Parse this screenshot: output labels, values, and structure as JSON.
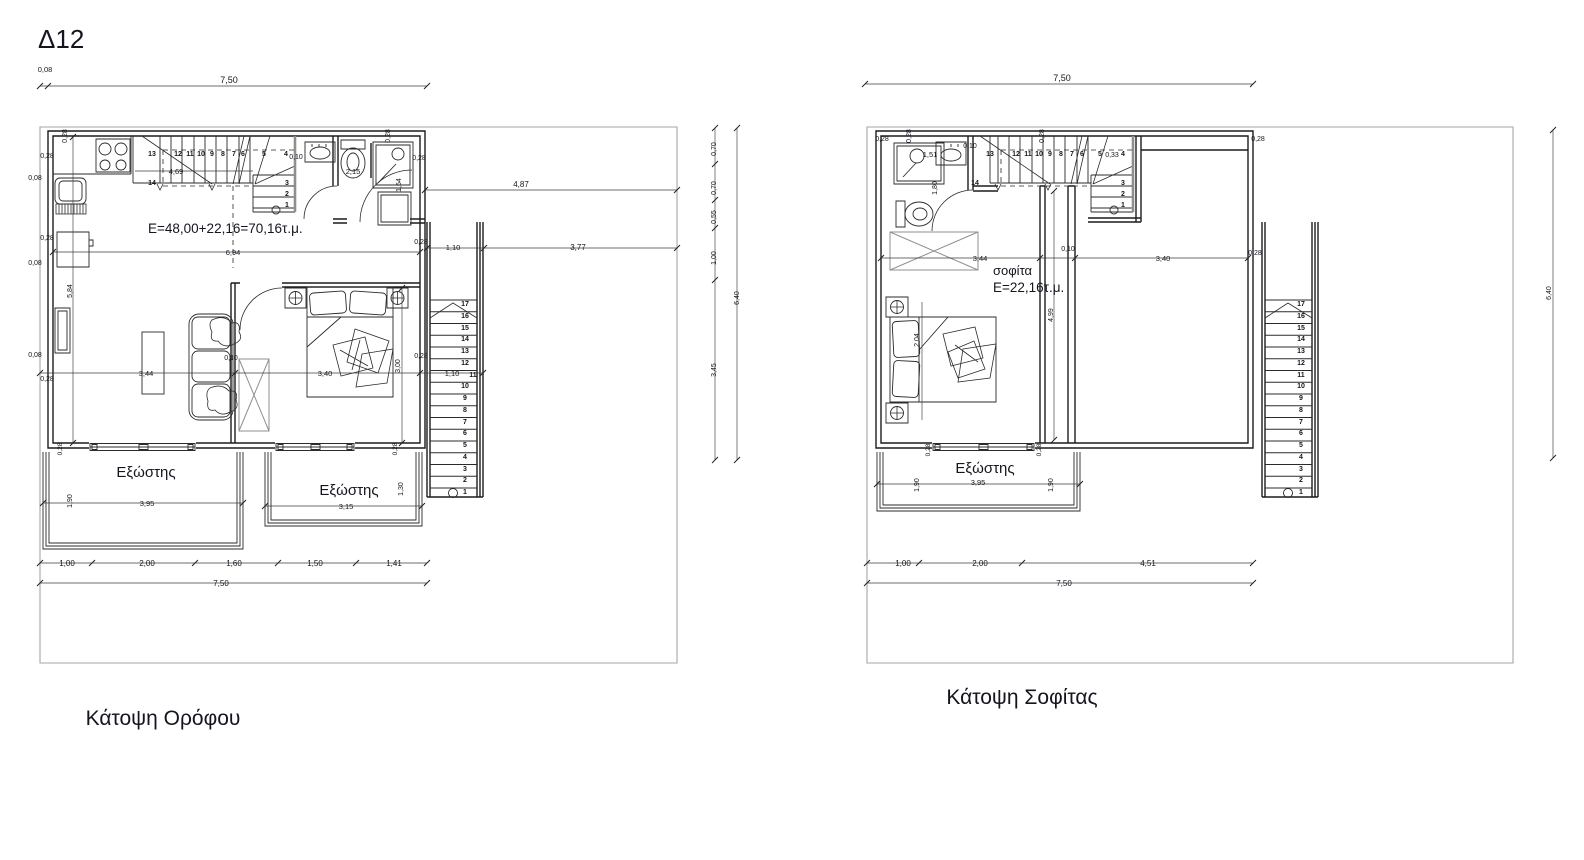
{
  "sheet": {
    "code": "Δ12"
  },
  "floor_plan": {
    "caption": "Κάτοψη Ορόφου",
    "area_label": "E=48,00+22,16=70,16τ.μ.",
    "balcony_labels": [
      "Εξώστης",
      "Εξώστης"
    ]
  },
  "attic_plan": {
    "caption": "Κάτοψη Σοφίτας",
    "room_label": "σοφίτα",
    "area_label": "E=22,16τ.μ.",
    "balcony_labels": [
      "Εξώστης"
    ]
  },
  "layers": [
    {
      "name": "sheet-labels",
      "labels": [
        {
          "t": "Δ12",
          "x": 38,
          "y": 48,
          "s": 26,
          "a": "start",
          "n": "sheet-code"
        }
      ]
    },
    {
      "name": "floor-plan-labels",
      "labels": [
        {
          "t": "Κάτοψη Ορόφου",
          "x": 163,
          "y": 725,
          "s": 21,
          "n": "floor-plan-caption"
        },
        {
          "t": "E=48,00+22,16=70,16τ.μ.",
          "x": 148,
          "y": 233,
          "s": 13.5,
          "a": "start",
          "n": "floor-area-label"
        },
        {
          "t": "Εξώστης",
          "x": 146,
          "y": 477,
          "s": 15,
          "n": "balcony-label"
        },
        {
          "t": "Εξώστης",
          "x": 349,
          "y": 495,
          "s": 15,
          "n": "balcony-label"
        },
        {
          "t": "0,08",
          "x": 45,
          "y": 72,
          "s": 7.5
        },
        {
          "t": "7,50",
          "x": 229,
          "y": 83,
          "s": 9
        },
        {
          "t": "0,28",
          "x": 67,
          "y": 136,
          "r": -90,
          "s": 7
        },
        {
          "t": "0,28",
          "x": 47,
          "y": 158,
          "s": 7
        },
        {
          "t": "0,08",
          "x": 35,
          "y": 180,
          "s": 7
        },
        {
          "t": "0,28",
          "x": 47,
          "y": 240,
          "s": 7
        },
        {
          "t": "0,08",
          "x": 35,
          "y": 265,
          "s": 7
        },
        {
          "t": "5,84",
          "x": 72,
          "y": 291,
          "r": -90,
          "s": 7
        },
        {
          "t": "0,08",
          "x": 35,
          "y": 357,
          "s": 7
        },
        {
          "t": "0,28",
          "x": 47,
          "y": 381,
          "s": 7
        },
        {
          "t": "4,69",
          "x": 176,
          "y": 174,
          "s": 7.5
        },
        {
          "t": "0,10",
          "x": 296,
          "y": 159,
          "s": 7
        },
        {
          "t": "2,15",
          "x": 353,
          "y": 174,
          "s": 7.5
        },
        {
          "t": "1,54",
          "x": 401,
          "y": 185,
          "r": -90,
          "s": 7
        },
        {
          "t": "0,28",
          "x": 390,
          "y": 136,
          "r": -90,
          "s": 7
        },
        {
          "t": "0,28",
          "x": 419,
          "y": 160,
          "s": 7
        },
        {
          "t": "4,87",
          "x": 521,
          "y": 187,
          "s": 8
        },
        {
          "t": "0,28",
          "x": 421,
          "y": 244,
          "s": 7
        },
        {
          "t": "1,10",
          "x": 453,
          "y": 250,
          "s": 7.5
        },
        {
          "t": "3,77",
          "x": 578,
          "y": 250,
          "s": 8
        },
        {
          "t": "6,94",
          "x": 233,
          "y": 255,
          "s": 7.5
        },
        {
          "t": "0,10",
          "x": 231,
          "y": 360,
          "s": 7
        },
        {
          "t": "3,44",
          "x": 146,
          "y": 376,
          "s": 7.5
        },
        {
          "t": "3,40",
          "x": 325,
          "y": 376,
          "s": 7.5
        },
        {
          "t": "3,00",
          "x": 400,
          "y": 366,
          "r": -90,
          "s": 7
        },
        {
          "t": "0,28",
          "x": 421,
          "y": 358,
          "s": 7
        },
        {
          "t": "1,10",
          "x": 452,
          "y": 376,
          "s": 7.5
        },
        {
          "t": "0,28",
          "x": 62,
          "y": 449,
          "r": -90,
          "s": 6.5
        },
        {
          "t": "0,28",
          "x": 397,
          "y": 449,
          "r": -90,
          "s": 6.5
        },
        {
          "t": "1,90",
          "x": 72,
          "y": 501,
          "r": -90,
          "s": 7
        },
        {
          "t": "3,95",
          "x": 147,
          "y": 506,
          "s": 7.5
        },
        {
          "t": "1,30",
          "x": 403,
          "y": 489,
          "r": -90,
          "s": 7
        },
        {
          "t": "3,15",
          "x": 346,
          "y": 509,
          "s": 7.5
        },
        {
          "t": "1,00",
          "x": 67,
          "y": 566,
          "s": 8
        },
        {
          "t": "2,00",
          "x": 147,
          "y": 566,
          "s": 8
        },
        {
          "t": "1,60",
          "x": 234,
          "y": 566,
          "s": 8
        },
        {
          "t": "1,50",
          "x": 315,
          "y": 566,
          "s": 8
        },
        {
          "t": "1,41",
          "x": 394,
          "y": 566,
          "s": 8
        },
        {
          "t": "7,50",
          "x": 221,
          "y": 586,
          "s": 8
        },
        {
          "t": "0,70",
          "x": 716,
          "y": 149,
          "r": -90,
          "s": 7
        },
        {
          "t": "0,70",
          "x": 716,
          "y": 188,
          "r": -90,
          "s": 7
        },
        {
          "t": "0,55",
          "x": 716,
          "y": 217,
          "r": -90,
          "s": 7
        },
        {
          "t": "1,00",
          "x": 716,
          "y": 258,
          "r": -90,
          "s": 7
        },
        {
          "t": "3,45",
          "x": 716,
          "y": 370,
          "r": -90,
          "s": 7
        },
        {
          "t": "6,40",
          "x": 739,
          "y": 298,
          "r": -90,
          "s": 7
        },
        {
          "t": "13",
          "x": 152,
          "y": 156,
          "s": 7,
          "w": "bold",
          "n": "stair-step-number"
        },
        {
          "t": "12",
          "x": 178,
          "y": 156,
          "s": 7,
          "w": "bold",
          "n": "stair-step-number"
        },
        {
          "t": "11",
          "x": 190,
          "y": 156,
          "s": 7,
          "w": "bold",
          "n": "stair-step-number"
        },
        {
          "t": "10",
          "x": 201,
          "y": 156,
          "s": 7,
          "w": "bold",
          "n": "stair-step-number"
        },
        {
          "t": "9",
          "x": 212,
          "y": 156,
          "s": 7,
          "w": "bold",
          "n": "stair-step-number"
        },
        {
          "t": "8",
          "x": 223,
          "y": 156,
          "s": 7,
          "w": "bold",
          "n": "stair-step-number"
        },
        {
          "t": "7",
          "x": 234,
          "y": 156,
          "s": 7,
          "w": "bold",
          "n": "stair-step-number"
        },
        {
          "t": "6",
          "x": 243,
          "y": 156,
          "s": 7,
          "w": "bold",
          "n": "stair-step-number"
        },
        {
          "t": "5",
          "x": 264,
          "y": 156,
          "s": 7,
          "w": "bold",
          "n": "stair-step-number"
        },
        {
          "t": "4",
          "x": 286,
          "y": 156,
          "s": 7,
          "w": "bold",
          "n": "stair-step-number"
        },
        {
          "t": "14",
          "x": 152,
          "y": 185,
          "s": 7,
          "w": "bold",
          "n": "stair-step-number"
        },
        {
          "t": "3",
          "x": 287,
          "y": 185,
          "s": 7,
          "w": "bold",
          "n": "stair-step-number"
        },
        {
          "t": "2",
          "x": 287,
          "y": 196,
          "s": 7,
          "w": "bold",
          "n": "stair-step-number"
        },
        {
          "t": "1",
          "x": 287,
          "y": 207,
          "s": 7,
          "w": "bold",
          "n": "stair-step-number"
        },
        {
          "t": "17",
          "x": 465,
          "y": 306,
          "s": 7,
          "w": "bold",
          "n": "stair-step-number"
        },
        {
          "t": "16",
          "x": 465,
          "y": 318,
          "s": 7,
          "w": "bold",
          "n": "stair-step-number"
        },
        {
          "t": "15",
          "x": 465,
          "y": 330,
          "s": 7,
          "w": "bold",
          "n": "stair-step-number"
        },
        {
          "t": "14",
          "x": 465,
          "y": 341,
          "s": 7,
          "w": "bold",
          "n": "stair-step-number"
        },
        {
          "t": "13",
          "x": 465,
          "y": 353,
          "s": 7,
          "w": "bold",
          "n": "stair-step-number"
        },
        {
          "t": "12",
          "x": 465,
          "y": 365,
          "s": 7,
          "w": "bold",
          "n": "stair-step-number"
        },
        {
          "t": "11",
          "x": 473,
          "y": 377,
          "s": 7,
          "w": "bold",
          "n": "stair-step-number"
        },
        {
          "t": "10",
          "x": 465,
          "y": 388,
          "s": 7,
          "w": "bold",
          "n": "stair-step-number"
        },
        {
          "t": "9",
          "x": 465,
          "y": 400,
          "s": 7,
          "w": "bold",
          "n": "stair-step-number"
        },
        {
          "t": "8",
          "x": 465,
          "y": 412,
          "s": 7,
          "w": "bold",
          "n": "stair-step-number"
        },
        {
          "t": "7",
          "x": 465,
          "y": 424,
          "s": 7,
          "w": "bold",
          "n": "stair-step-number"
        },
        {
          "t": "6",
          "x": 465,
          "y": 435,
          "s": 7,
          "w": "bold",
          "n": "stair-step-number"
        },
        {
          "t": "5",
          "x": 465,
          "y": 447,
          "s": 7,
          "w": "bold",
          "n": "stair-step-number"
        },
        {
          "t": "4",
          "x": 465,
          "y": 459,
          "s": 7,
          "w": "bold",
          "n": "stair-step-number"
        },
        {
          "t": "3",
          "x": 465,
          "y": 471,
          "s": 7,
          "w": "bold",
          "n": "stair-step-number"
        },
        {
          "t": "2",
          "x": 465,
          "y": 482,
          "s": 7,
          "w": "bold",
          "n": "stair-step-number"
        },
        {
          "t": "1",
          "x": 465,
          "y": 494,
          "s": 7,
          "w": "bold",
          "n": "stair-step-number"
        }
      ]
    },
    {
      "name": "attic-plan-labels",
      "labels": [
        {
          "t": "Κάτοψη Σοφίτας",
          "x": 1022,
          "y": 704,
          "s": 21,
          "n": "attic-plan-caption"
        },
        {
          "t": "σοφίτα",
          "x": 993,
          "y": 275,
          "s": 13,
          "a": "start",
          "n": "attic-room-label"
        },
        {
          "t": "E=22,16τ.μ.",
          "x": 993,
          "y": 292,
          "s": 13.5,
          "a": "start",
          "n": "attic-area-label"
        },
        {
          "t": "Εξώστης",
          "x": 985,
          "y": 473,
          "s": 15,
          "n": "balcony-label"
        },
        {
          "t": "7,50",
          "x": 1062,
          "y": 81,
          "s": 9
        },
        {
          "t": "0,28",
          "x": 882,
          "y": 141,
          "s": 7
        },
        {
          "t": "0,28",
          "x": 911,
          "y": 136,
          "r": -90,
          "s": 7
        },
        {
          "t": "0,28",
          "x": 1044,
          "y": 136,
          "r": -90,
          "s": 7
        },
        {
          "t": "0,28",
          "x": 1258,
          "y": 141,
          "s": 7
        },
        {
          "t": "0,10",
          "x": 970,
          "y": 148,
          "s": 7
        },
        {
          "t": "1,51",
          "x": 930,
          "y": 157,
          "s": 7.5
        },
        {
          "t": "1,80",
          "x": 937,
          "y": 188,
          "r": -90,
          "s": 7
        },
        {
          "t": "0,33",
          "x": 1112,
          "y": 157,
          "s": 7
        },
        {
          "t": "3,44",
          "x": 980,
          "y": 261,
          "s": 7.5
        },
        {
          "t": "0,10",
          "x": 1068,
          "y": 251,
          "s": 7
        },
        {
          "t": "3,40",
          "x": 1163,
          "y": 261,
          "s": 7.5
        },
        {
          "t": "0,28",
          "x": 1255,
          "y": 255,
          "s": 7
        },
        {
          "t": "4,99",
          "x": 1053,
          "y": 315,
          "r": -90,
          "s": 7
        },
        {
          "t": "2,04",
          "x": 919,
          "y": 340,
          "r": -90,
          "s": 7
        },
        {
          "t": "0,28",
          "x": 930,
          "y": 450,
          "r": -90,
          "s": 6.5
        },
        {
          "t": "0,28",
          "x": 1041,
          "y": 450,
          "r": -90,
          "s": 6.5
        },
        {
          "t": "1,90",
          "x": 919,
          "y": 485,
          "r": -90,
          "s": 7
        },
        {
          "t": "1,90",
          "x": 1053,
          "y": 485,
          "r": -90,
          "s": 7
        },
        {
          "t": "3,95",
          "x": 978,
          "y": 485,
          "s": 7.5
        },
        {
          "t": "1,00",
          "x": 903,
          "y": 566,
          "s": 8
        },
        {
          "t": "2,00",
          "x": 980,
          "y": 566,
          "s": 8
        },
        {
          "t": "4,51",
          "x": 1148,
          "y": 566,
          "s": 8
        },
        {
          "t": "7,50",
          "x": 1064,
          "y": 586,
          "s": 8
        },
        {
          "t": "6,40",
          "x": 1551,
          "y": 293,
          "r": -90,
          "s": 7
        },
        {
          "t": "13",
          "x": 990,
          "y": 156,
          "s": 7,
          "w": "bold",
          "n": "stair-step-number"
        },
        {
          "t": "12",
          "x": 1016,
          "y": 156,
          "s": 7,
          "w": "bold",
          "n": "stair-step-number"
        },
        {
          "t": "11",
          "x": 1028,
          "y": 156,
          "s": 7,
          "w": "bold",
          "n": "stair-step-number"
        },
        {
          "t": "10",
          "x": 1039,
          "y": 156,
          "s": 7,
          "w": "bold",
          "n": "stair-step-number"
        },
        {
          "t": "9",
          "x": 1050,
          "y": 156,
          "s": 7,
          "w": "bold",
          "n": "stair-step-number"
        },
        {
          "t": "8",
          "x": 1061,
          "y": 156,
          "s": 7,
          "w": "bold",
          "n": "stair-step-number"
        },
        {
          "t": "7",
          "x": 1072,
          "y": 156,
          "s": 7,
          "w": "bold",
          "n": "stair-step-number"
        },
        {
          "t": "6",
          "x": 1082,
          "y": 156,
          "s": 7,
          "w": "bold",
          "n": "stair-step-number"
        },
        {
          "t": "5",
          "x": 1100,
          "y": 156,
          "s": 7,
          "w": "bold",
          "n": "stair-step-number"
        },
        {
          "t": "4",
          "x": 1123,
          "y": 156,
          "s": 7,
          "w": "bold",
          "n": "stair-step-number"
        },
        {
          "t": "14",
          "x": 975,
          "y": 185,
          "s": 7,
          "w": "bold",
          "n": "stair-step-number"
        },
        {
          "t": "3",
          "x": 1123,
          "y": 185,
          "s": 7,
          "w": "bold",
          "n": "stair-step-number"
        },
        {
          "t": "2",
          "x": 1123,
          "y": 196,
          "s": 7,
          "w": "bold",
          "n": "stair-step-number"
        },
        {
          "t": "1",
          "x": 1123,
          "y": 207,
          "s": 7,
          "w": "bold",
          "n": "stair-step-number"
        },
        {
          "t": "17",
          "x": 1301,
          "y": 306,
          "s": 7,
          "w": "bold",
          "n": "stair-step-number"
        },
        {
          "t": "16",
          "x": 1301,
          "y": 318,
          "s": 7,
          "w": "bold",
          "n": "stair-step-number"
        },
        {
          "t": "15",
          "x": 1301,
          "y": 330,
          "s": 7,
          "w": "bold",
          "n": "stair-step-number"
        },
        {
          "t": "14",
          "x": 1301,
          "y": 341,
          "s": 7,
          "w": "bold",
          "n": "stair-step-number"
        },
        {
          "t": "13",
          "x": 1301,
          "y": 353,
          "s": 7,
          "w": "bold",
          "n": "stair-step-number"
        },
        {
          "t": "12",
          "x": 1301,
          "y": 365,
          "s": 7,
          "w": "bold",
          "n": "stair-step-number"
        },
        {
          "t": "11",
          "x": 1301,
          "y": 377,
          "s": 7,
          "w": "bold",
          "n": "stair-step-number"
        },
        {
          "t": "10",
          "x": 1301,
          "y": 388,
          "s": 7,
          "w": "bold",
          "n": "stair-step-number"
        },
        {
          "t": "9",
          "x": 1301,
          "y": 400,
          "s": 7,
          "w": "bold",
          "n": "stair-step-number"
        },
        {
          "t": "8",
          "x": 1301,
          "y": 412,
          "s": 7,
          "w": "bold",
          "n": "stair-step-number"
        },
        {
          "t": "7",
          "x": 1301,
          "y": 424,
          "s": 7,
          "w": "bold",
          "n": "stair-step-number"
        },
        {
          "t": "6",
          "x": 1301,
          "y": 435,
          "s": 7,
          "w": "bold",
          "n": "stair-step-number"
        },
        {
          "t": "5",
          "x": 1301,
          "y": 447,
          "s": 7,
          "w": "bold",
          "n": "stair-step-number"
        },
        {
          "t": "4",
          "x": 1301,
          "y": 459,
          "s": 7,
          "w": "bold",
          "n": "stair-step-number"
        },
        {
          "t": "3",
          "x": 1301,
          "y": 471,
          "s": 7,
          "w": "bold",
          "n": "stair-step-number"
        },
        {
          "t": "2",
          "x": 1301,
          "y": 482,
          "s": 7,
          "w": "bold",
          "n": "stair-step-number"
        },
        {
          "t": "1",
          "x": 1301,
          "y": 494,
          "s": 7,
          "w": "bold",
          "n": "stair-step-number"
        }
      ]
    }
  ]
}
